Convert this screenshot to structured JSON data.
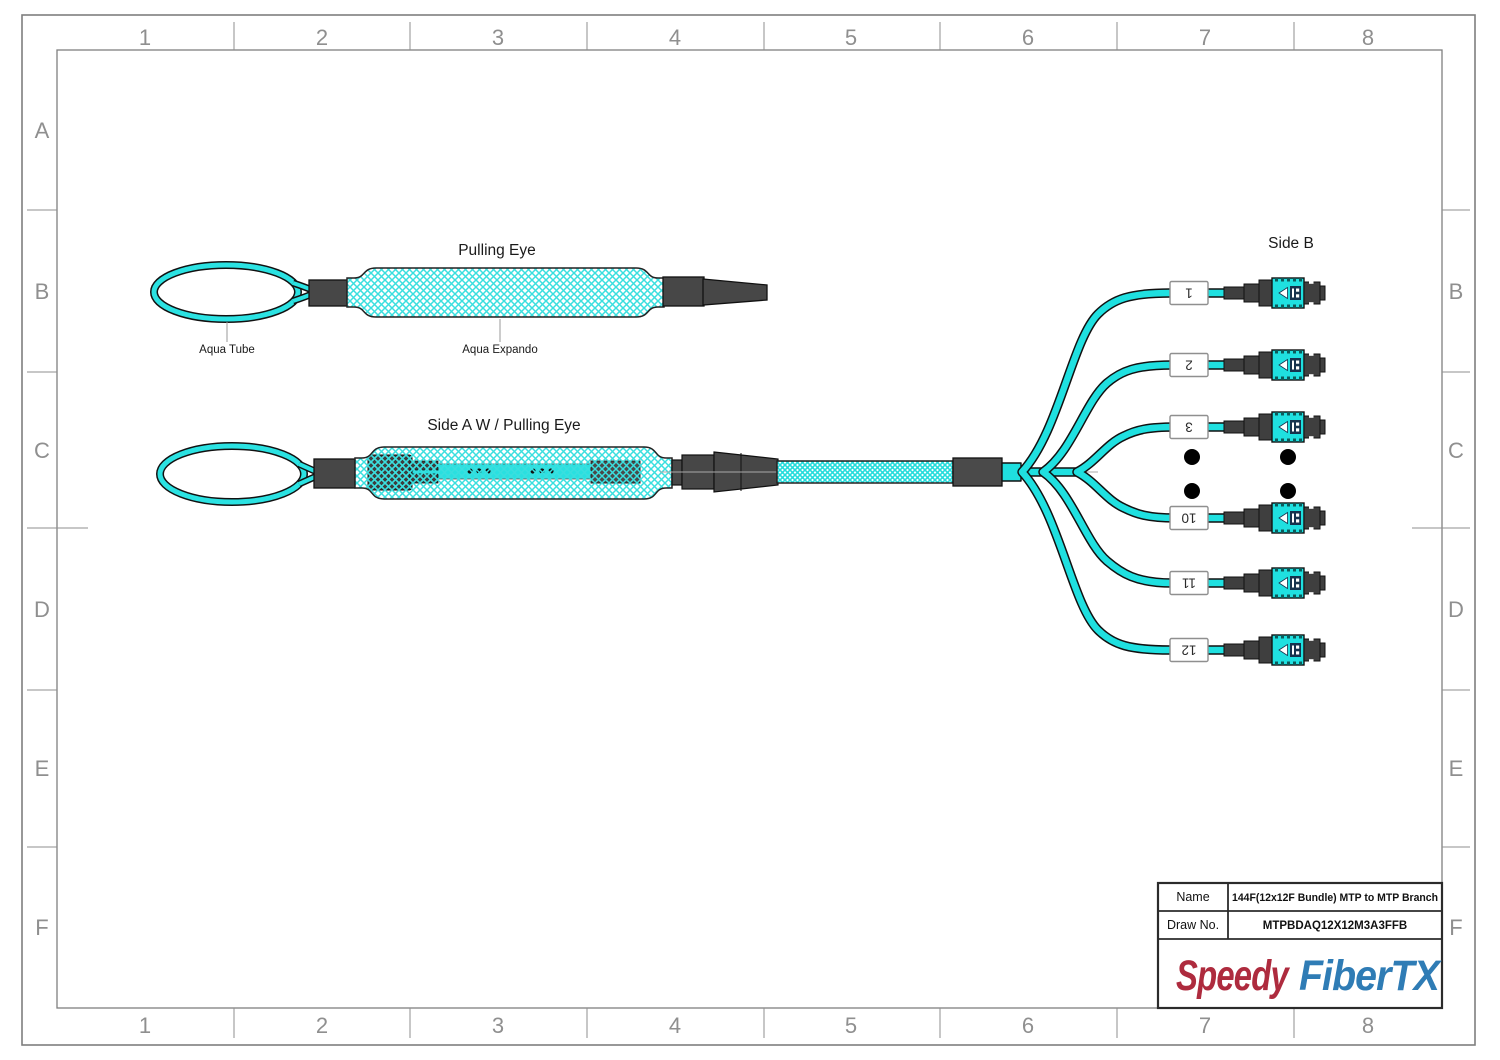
{
  "sheet": {
    "grid_cols": [
      "1",
      "2",
      "3",
      "4",
      "5",
      "6",
      "7",
      "8"
    ],
    "grid_rows": [
      "A",
      "B",
      "C",
      "D",
      "E",
      "F"
    ]
  },
  "diagram": {
    "pulling_eye_title": "Pulling Eye",
    "aqua_tube_label": "Aqua Tube",
    "aqua_expando_label": "Aqua Expando",
    "side_a_title": "Side A W / Pulling Eye",
    "side_b_title": "Side B",
    "branch_labels": [
      "1",
      "2",
      "3",
      "10",
      "11",
      "12"
    ]
  },
  "title_block": {
    "name_label": "Name",
    "name_value": "144F(12x12F Bundle) MTP to MTP Branch",
    "draw_no_label": "Draw No.",
    "draw_no_value": "MTPBDAQ12X12M3A3FFB",
    "logo_part1": "Speedy",
    "logo_part2": "FiberTX"
  },
  "colors": {
    "fiber_aqua": "#1FE0E0",
    "connector_gray": "#474747",
    "logo_red": "#AE2B3E",
    "logo_blue": "#2F7CB5"
  }
}
